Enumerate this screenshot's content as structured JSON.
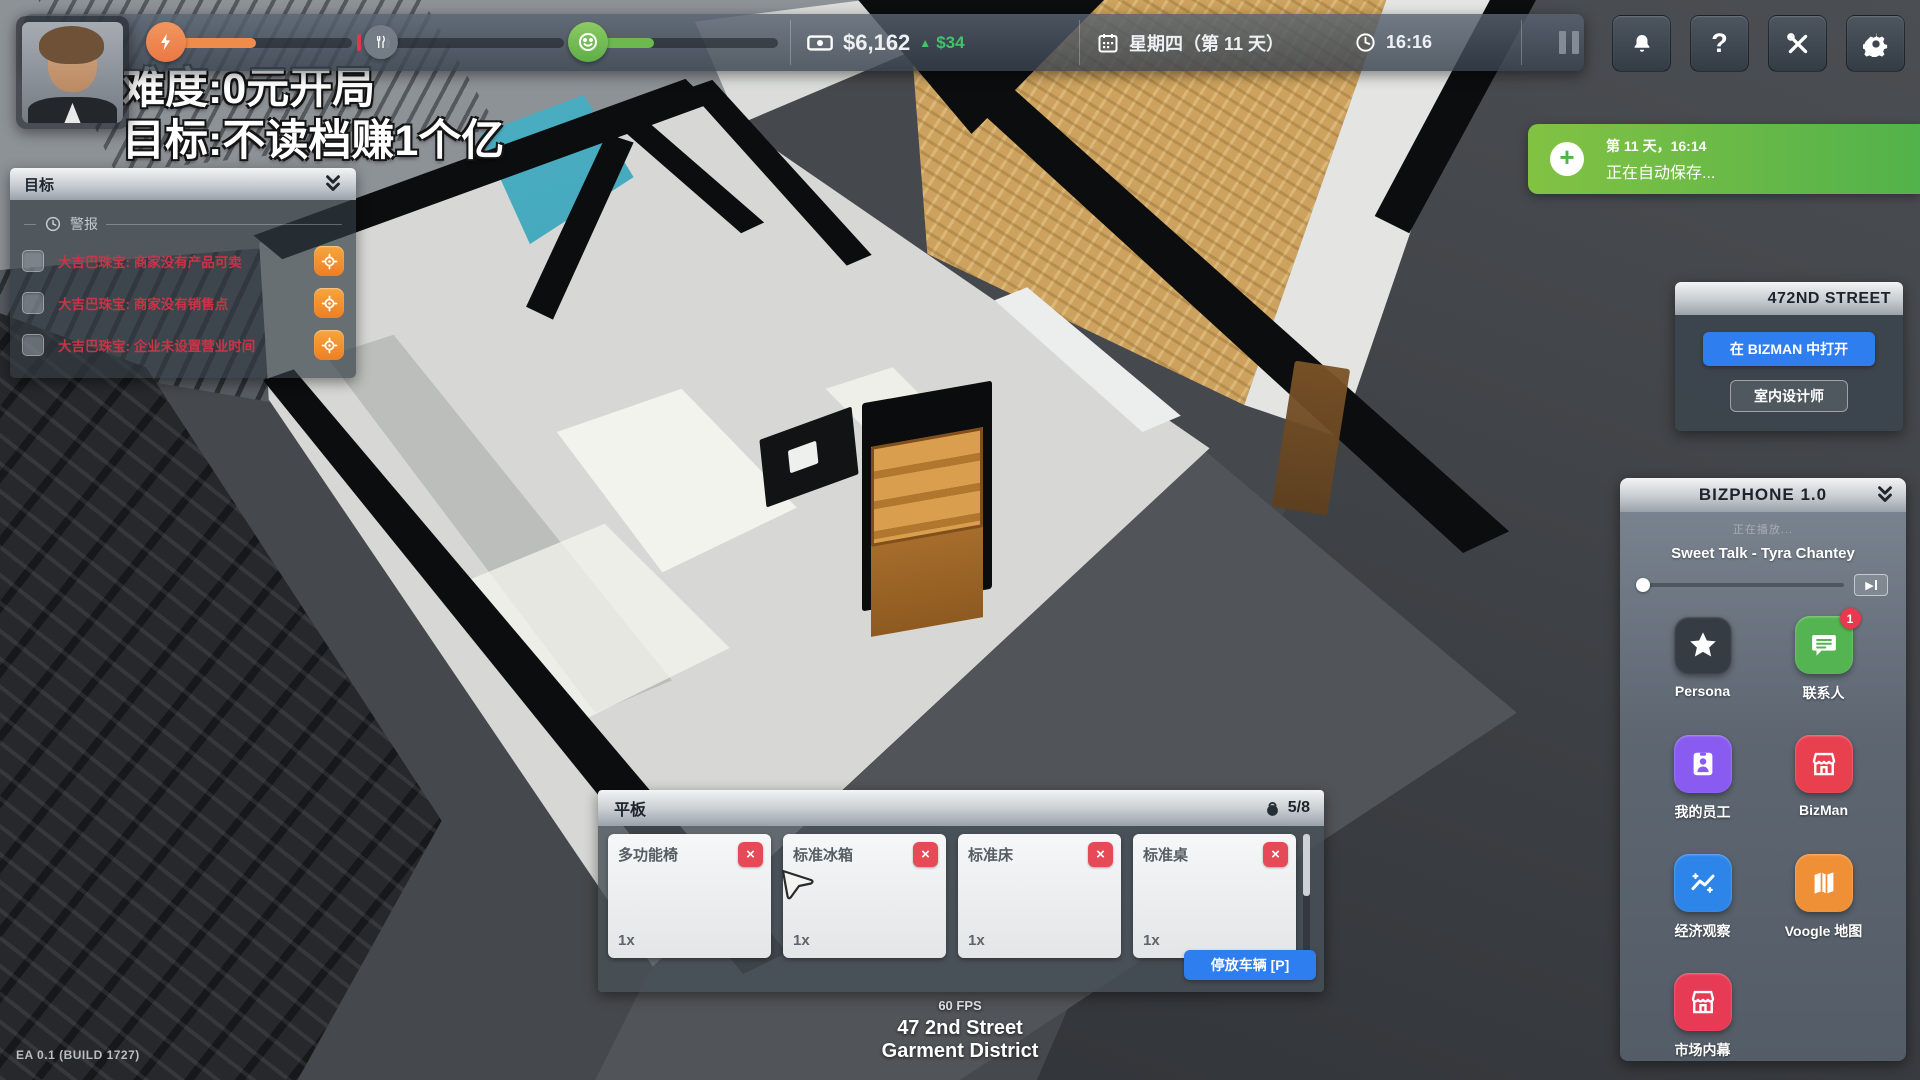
{
  "meta": {
    "version_label": "EA 0.1 (BUILD 1727)"
  },
  "overlay": {
    "line1": "难度:0元开局",
    "line2": "目标:不读档赚1个亿"
  },
  "topbar": {
    "stats": {
      "energy": "47%",
      "hunger": "2%",
      "happiness": "32%"
    },
    "money": "$6,162",
    "money_delta_arrow": "▲",
    "money_delta": "$34",
    "date": "星期四（第 11 天）",
    "time": "16:16"
  },
  "goals": {
    "title": "目标",
    "alerts_header": "警报",
    "alerts": [
      "大吉巴珠宝: 商家没有产品可卖",
      "大吉巴珠宝: 商家没有销售点",
      "大吉巴珠宝: 企业未设置营业时间"
    ]
  },
  "toast": {
    "line1": "第 11 天，16:14",
    "line2": "正在自动保存..."
  },
  "street_panel": {
    "title": "472ND STREET",
    "open_button": "在 BIZMAN 中打开",
    "designer_button": "室内设计师"
  },
  "bizphone": {
    "title": "BIZPHONE 1.0",
    "now_playing": "正在播放...",
    "track": "Sweet Talk - Tyra Chantey",
    "apps": [
      {
        "label": "Persona",
        "color": "#363c43",
        "badge": ""
      },
      {
        "label": "联系人",
        "color": "#55b452",
        "badge": "1"
      },
      {
        "label": "我的员工",
        "color": "#8a5bf0",
        "badge": ""
      },
      {
        "label": "BizMan",
        "color": "#e8404f",
        "badge": ""
      },
      {
        "label": "经济观察",
        "color": "#2d85ea",
        "badge": ""
      },
      {
        "label": "Voogle 地图",
        "color": "#f09036",
        "badge": ""
      },
      {
        "label": "市场内幕",
        "color": "#e73a55",
        "badge": ""
      }
    ]
  },
  "vehicle": {
    "title": "平板",
    "capacity": "5/8",
    "items": [
      {
        "name": "多功能椅",
        "qty": "1x"
      },
      {
        "name": "标准冰箱",
        "qty": "1x"
      },
      {
        "name": "标准床",
        "qty": "1x"
      },
      {
        "name": "标准桌",
        "qty": "1x"
      }
    ],
    "park_button": "停放车辆 [P]"
  },
  "footer": {
    "fps": "60 FPS",
    "address": "47 2nd Street",
    "district": "Garment District"
  },
  "colors": {
    "accent_blue": "#2e7ef0",
    "alert_red": "#cb3347",
    "toast_green": "#52b24b",
    "money_green": "#3fc46a",
    "energy_orange": "#ea7844",
    "happy_green": "#6db84f"
  }
}
